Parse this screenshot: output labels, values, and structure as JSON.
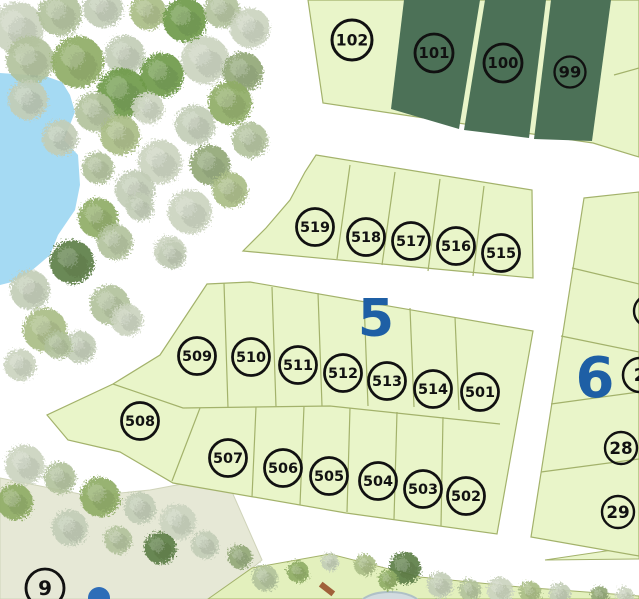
{
  "map": {
    "type": "residential-subdivision-site-plan",
    "colors": {
      "background": "#ffffff",
      "parcel_light": "#e9f5c9",
      "parcel_dark": "#4c7157",
      "parcel_border": "#a3b26b",
      "water": "#a5daf3",
      "park_ground": "#e6e8d6",
      "park_strip": "#e3f0bd",
      "block_label": "#1e5fa5",
      "marker_ink": "#111111",
      "pool_dot": "#2e6db8"
    },
    "block_labels": [
      {
        "label": "5",
        "x": 376,
        "y": 336,
        "size": 52
      },
      {
        "label": "6",
        "x": 595,
        "y": 397,
        "size": 56
      }
    ],
    "lot_markers": [
      {
        "label": "102",
        "x": 352,
        "y": 40,
        "r": 20
      },
      {
        "label": "101",
        "x": 434,
        "y": 53,
        "r": 19
      },
      {
        "label": "100",
        "x": 503,
        "y": 63,
        "r": 19
      },
      {
        "label": "99",
        "x": 570,
        "y": 72,
        "r": 15.5
      },
      {
        "label": "519",
        "x": 315,
        "y": 227,
        "r": 18.5
      },
      {
        "label": "518",
        "x": 366,
        "y": 237,
        "r": 18.5
      },
      {
        "label": "517",
        "x": 411,
        "y": 241,
        "r": 18.5
      },
      {
        "label": "516",
        "x": 456,
        "y": 246,
        "r": 18.5
      },
      {
        "label": "515",
        "x": 501,
        "y": 253,
        "r": 18.5
      },
      {
        "label": "509",
        "x": 197,
        "y": 356,
        "r": 18.5
      },
      {
        "label": "510",
        "x": 251,
        "y": 357,
        "r": 18.5
      },
      {
        "label": "511",
        "x": 298,
        "y": 365,
        "r": 18.5
      },
      {
        "label": "512",
        "x": 343,
        "y": 373,
        "r": 18.5
      },
      {
        "label": "513",
        "x": 387,
        "y": 381,
        "r": 18.5
      },
      {
        "label": "514",
        "x": 433,
        "y": 389,
        "r": 18.5
      },
      {
        "label": "501",
        "x": 480,
        "y": 392,
        "r": 18.5
      },
      {
        "label": "508",
        "x": 140,
        "y": 421,
        "r": 18.5
      },
      {
        "label": "507",
        "x": 228,
        "y": 458,
        "r": 18.5
      },
      {
        "label": "506",
        "x": 283,
        "y": 468,
        "r": 18.5
      },
      {
        "label": "505",
        "x": 329,
        "y": 476,
        "r": 18.5
      },
      {
        "label": "504",
        "x": 378,
        "y": 481,
        "r": 18.5
      },
      {
        "label": "503",
        "x": 423,
        "y": 489,
        "r": 18.5
      },
      {
        "label": "502",
        "x": 466,
        "y": 496,
        "r": 18.5
      },
      {
        "label": "",
        "x": 650,
        "y": 311,
        "r": 16
      },
      {
        "label": "2",
        "x": 640,
        "y": 375,
        "r": 17
      },
      {
        "label": "28",
        "x": 621,
        "y": 448,
        "r": 16
      },
      {
        "label": "29",
        "x": 618,
        "y": 512,
        "r": 16
      },
      {
        "label": "9",
        "x": 45,
        "y": 588,
        "r": 19
      }
    ]
  }
}
